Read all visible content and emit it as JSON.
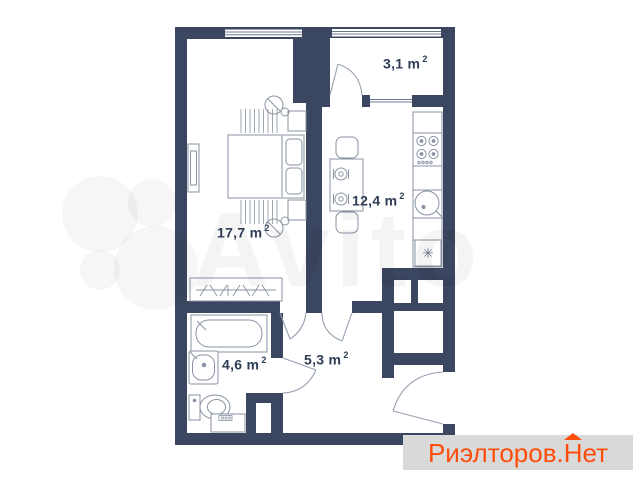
{
  "colors": {
    "wall": "#3b4760",
    "furniture_line": "#8a93a3",
    "label_text": "#2f3c55",
    "logo_text": "#ff4e0a",
    "logo_background": "#d9d9d9",
    "watermark": "rgba(0,0,0,0.04)",
    "background": "#ffffff"
  },
  "rooms": [
    {
      "name": "bedroom",
      "area": "17,7",
      "unit": "m",
      "sup": "2",
      "display": "17,7 m"
    },
    {
      "name": "kitchen",
      "area": "12,4",
      "unit": "m",
      "sup": "2",
      "display": "12,4 m"
    },
    {
      "name": "balcony",
      "area": "3,1",
      "unit": "m",
      "sup": "2",
      "display": "3,1 m"
    },
    {
      "name": "bathroom",
      "area": "4,6",
      "unit": "m",
      "sup": "2",
      "display": "4,6 m"
    },
    {
      "name": "hallway",
      "area": "5,3",
      "unit": "m",
      "sup": "2",
      "display": "5,3 m"
    }
  ],
  "watermark": {
    "brand": "Avito"
  },
  "logo": {
    "prefix": "Риэлторов.",
    "roofed_letter": "Н",
    "suffix": "ет",
    "full": "Риэлторов.Нет"
  },
  "icons": {
    "fridge_snowflake": "✳"
  }
}
